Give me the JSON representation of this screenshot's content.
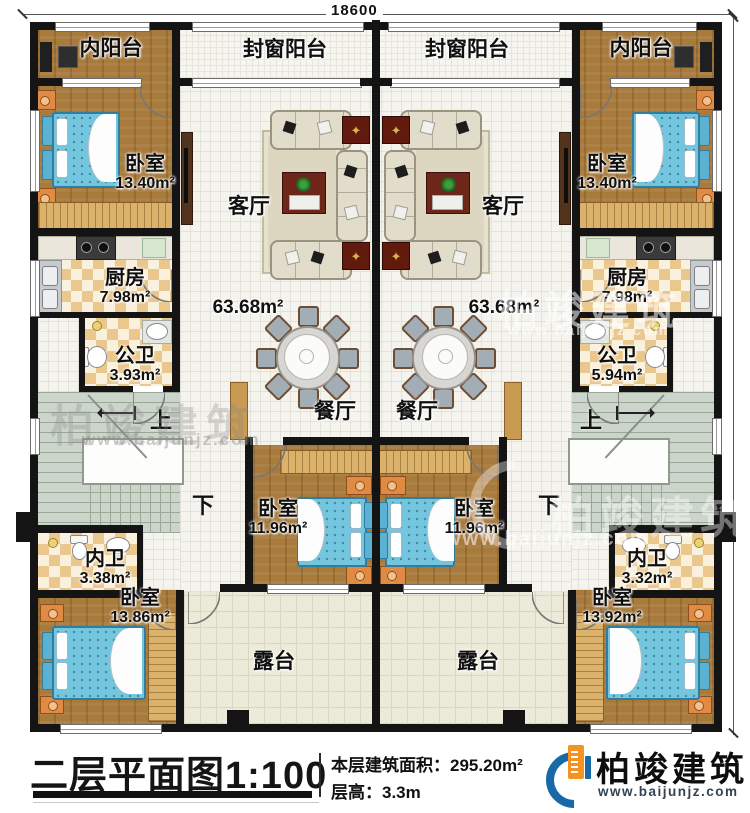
{
  "dimensions": {
    "top": "18600",
    "right": "18400"
  },
  "stairs": {
    "up": "上",
    "down": "下"
  },
  "units": {
    "left": {
      "inner_balcony": "内阳台",
      "enclosed_balcony": "封窗阳台",
      "living": "客厅",
      "living_area": "63.68m²",
      "dining": "餐厅",
      "bedroom_top": {
        "name": "卧室",
        "area": "13.40m²"
      },
      "kitchen": {
        "name": "厨房",
        "area": "7.98m²"
      },
      "public_bath": {
        "name": "公卫",
        "area": "3.93m²"
      },
      "bedroom_mid": {
        "name": "卧室",
        "area": "11.96m²"
      },
      "private_bath": {
        "name": "内卫",
        "area": "3.38m²"
      },
      "bedroom_bottom": {
        "name": "卧室",
        "area": "13.86m²"
      },
      "terrace": "露台"
    },
    "right": {
      "inner_balcony": "内阳台",
      "enclosed_balcony": "封窗阳台",
      "living": "客厅",
      "living_area": "63.68m²",
      "dining": "餐厅",
      "bedroom_top": {
        "name": "卧室",
        "area": "13.40m²"
      },
      "kitchen": {
        "name": "厨房",
        "area": "7.98m²"
      },
      "public_bath": {
        "name": "公卫",
        "area": "5.94m²"
      },
      "bedroom_mid": {
        "name": "卧室",
        "area": "11.96m²"
      },
      "private_bath": {
        "name": "内卫",
        "area": "3.32m²"
      },
      "bedroom_bottom": {
        "name": "卧室",
        "area": "13.92m²"
      },
      "terrace": "露台"
    }
  },
  "footer": {
    "title": "二层平面图",
    "scale": "1:100",
    "area_label": "本层建筑面积：",
    "area_value": "295.20m²",
    "floor_height_label": "层高：",
    "floor_height_value": "3.3m",
    "brand": "柏竣建筑",
    "brand_url": "www.baijunjz.com"
  },
  "watermark": {
    "brand": "柏竣建筑",
    "url": "www.baijunjz.com"
  }
}
